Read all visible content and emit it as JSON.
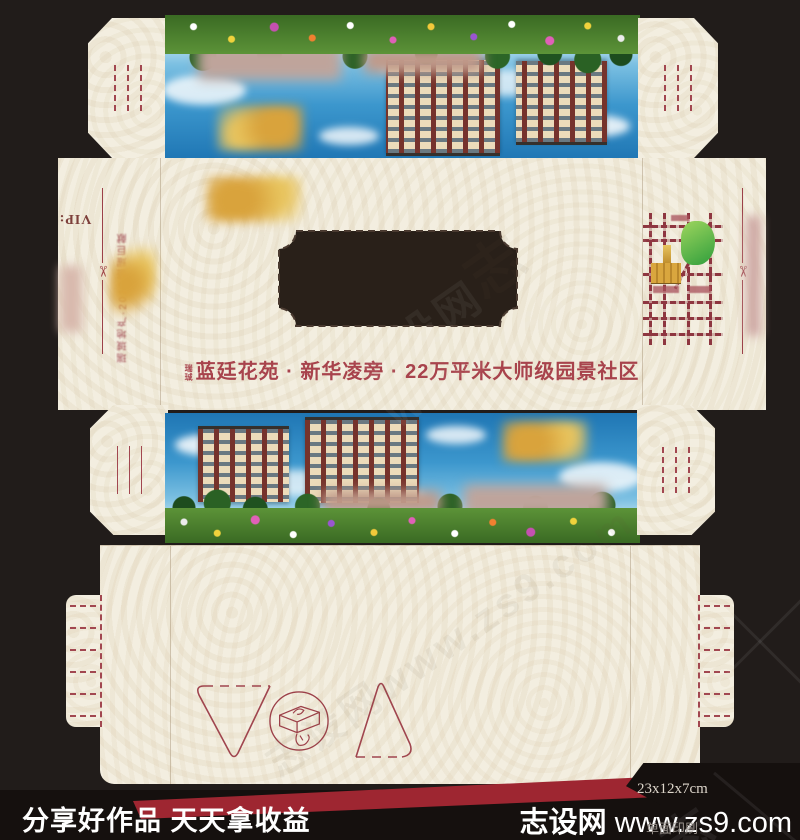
{
  "design": {
    "headline_prefix": [
      "瑞",
      "珹"
    ],
    "headline": "蓝廷花苑 · 新华凌旁 · 22万平米大师级园景社区",
    "vip_label": "VIP:",
    "side_note": "瑞珹地产·2013盛耀巨献",
    "scissors_glyph": "✂",
    "accent_red": "#a8434c",
    "cream": "#f3eee0"
  },
  "footer": {
    "slogan": "分享好作品 天天拿收益",
    "site_name": "志设网",
    "site_url": "www.zs9.com",
    "size_label": "23x12x7cm",
    "print_label": "单面印刷"
  },
  "watermark": {
    "text": "志设网www.zs9.com",
    "glyph": "志"
  }
}
